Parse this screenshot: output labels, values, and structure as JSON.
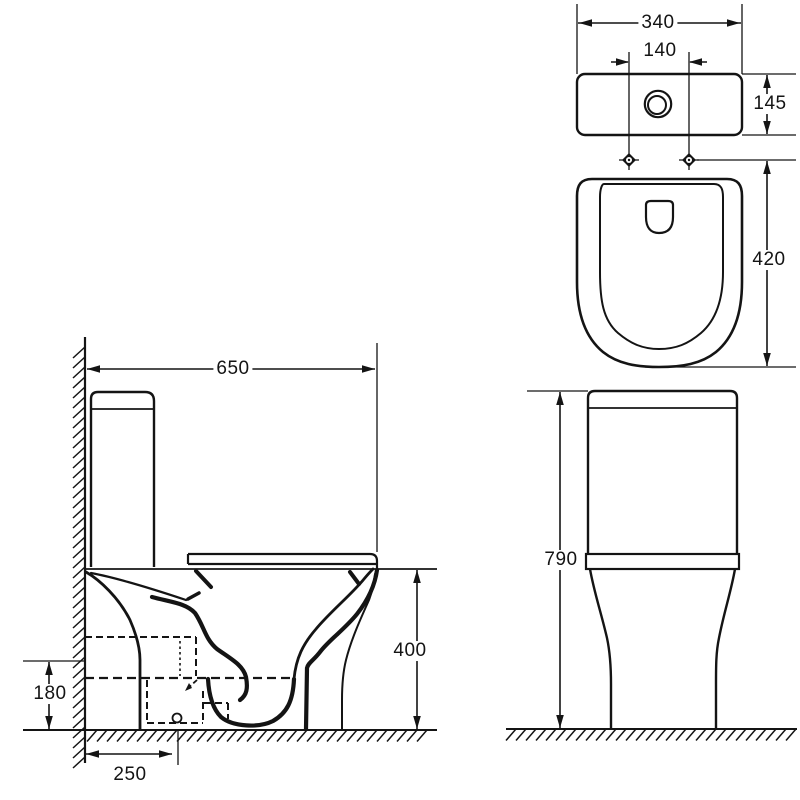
{
  "drawing": {
    "title": "Close-coupled toilet technical dimension drawing",
    "unit": "mm",
    "line_color": "#141414",
    "background_color": "#ffffff",
    "views": [
      {
        "id": "side",
        "label": "side section view with wall and floor"
      },
      {
        "id": "top",
        "label": "top plan view of cistern and bowl"
      },
      {
        "id": "front",
        "label": "front elevation view"
      }
    ]
  },
  "dimensions": [
    {
      "id": "overall-depth",
      "view": "side",
      "value": "650"
    },
    {
      "id": "seat-height",
      "view": "side",
      "value": "400"
    },
    {
      "id": "outlet-height",
      "view": "side",
      "value": "180"
    },
    {
      "id": "outlet-setout",
      "view": "side",
      "value": "250"
    },
    {
      "id": "cistern-width",
      "view": "top",
      "value": "340"
    },
    {
      "id": "fixing-centres",
      "view": "top",
      "value": "140"
    },
    {
      "id": "cistern-depth",
      "view": "top",
      "value": "145"
    },
    {
      "id": "bowl-length",
      "view": "top",
      "value": "420"
    },
    {
      "id": "overall-height",
      "view": "front",
      "value": "790"
    }
  ]
}
